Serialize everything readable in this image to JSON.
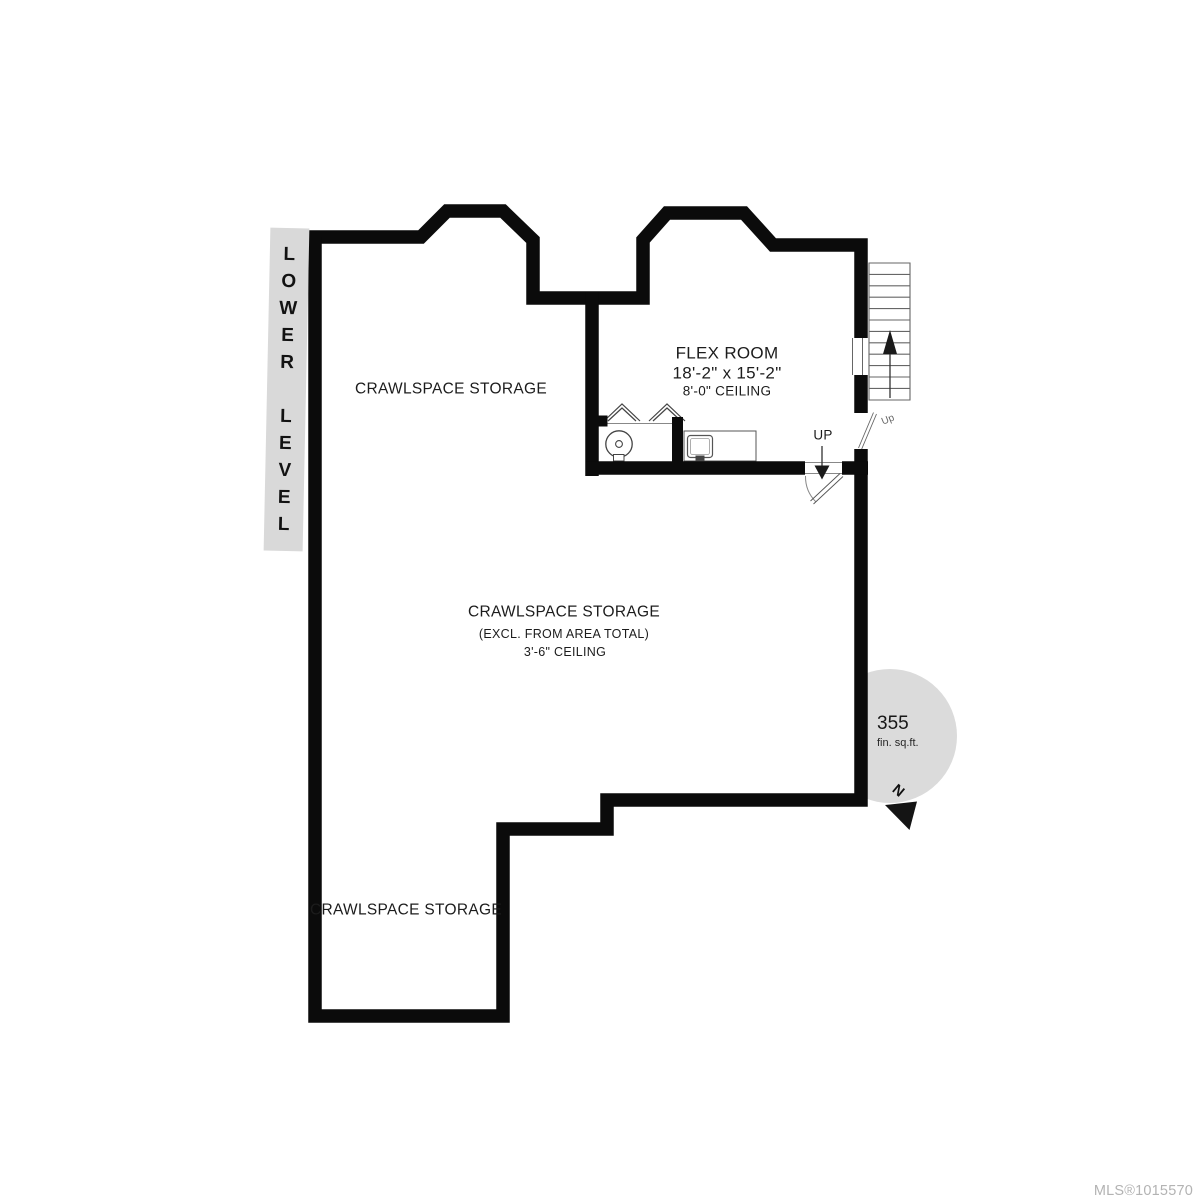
{
  "title_band": {
    "text": "L\nO\nW\nE\nR\n\nL\nE\nV\nE\nL"
  },
  "rooms": {
    "crawlspace_top": {
      "label": "CRAWLSPACE STORAGE"
    },
    "flex_room": {
      "name": "FLEX ROOM",
      "dimensions": "18'-2\" x 15'-2\"",
      "ceiling": "8'-0\" CEILING"
    },
    "crawlspace_main": {
      "label": "CRAWLSPACE STORAGE",
      "note": "(EXCL. FROM AREA TOTAL)",
      "ceiling": "3'-6\" CEILING"
    },
    "crawlspace_bottom": {
      "label": "CRAWLSPACE STORAGE"
    }
  },
  "stairs": {
    "direction_label": "UP",
    "door_label": "Up"
  },
  "area_badge": {
    "value": "355",
    "unit": "fin. sq.ft."
  },
  "compass": {
    "label": "N"
  },
  "footer": {
    "mls_number": "MLS®1015570"
  },
  "colors": {
    "wall": "#0b0b0b",
    "band_background": "#d9d9d9",
    "badge_background": "#dbdbdb",
    "thin_line": "#666666",
    "mls_text": "#b3b3b3"
  }
}
